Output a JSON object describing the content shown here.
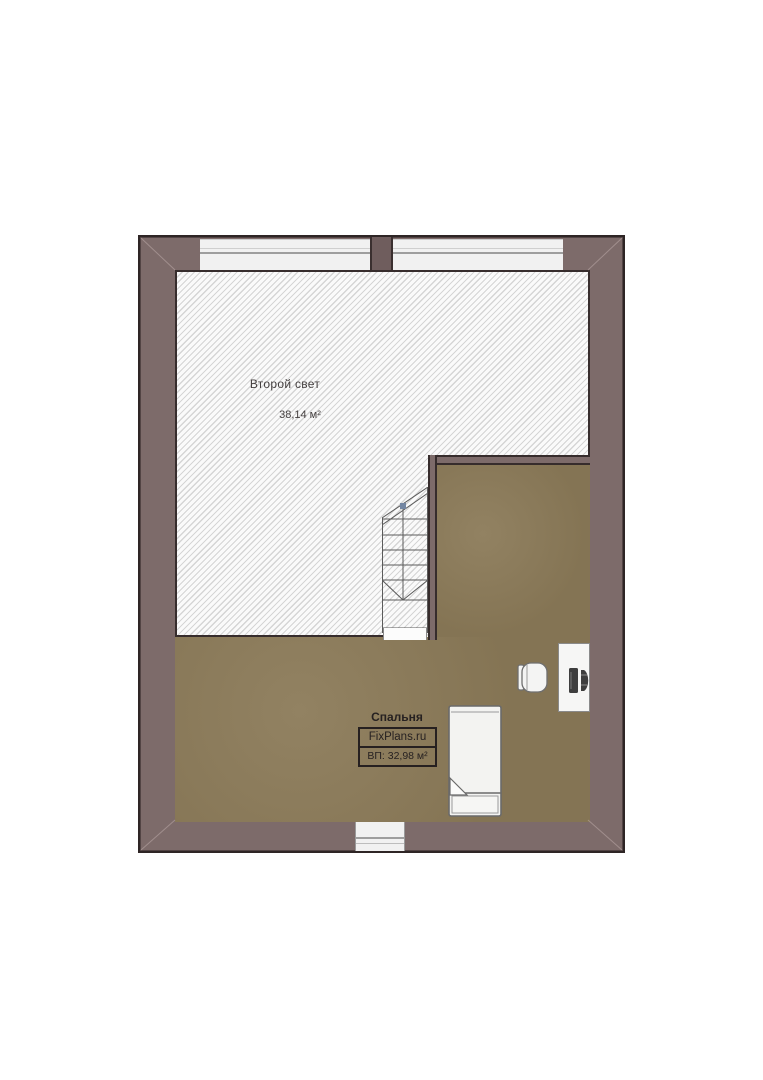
{
  "colors": {
    "wall_fill": "#7d6b6a",
    "wall_dark": "#2e2525",
    "floor_wood": "#8b7a58",
    "hatch_bg": "#fafafa",
    "hatch_line": "#d5d5d5",
    "window_fill": "#f1f1f1",
    "line_gray": "#9e9e9e",
    "stair_marker": "#7386a2",
    "text_dark": "#262121",
    "text_gray": "#454040"
  },
  "rooms": {
    "second_light": {
      "name": "Второй свет",
      "area": "38,14 м²"
    },
    "bedroom": {
      "name": "Спальня",
      "watermark": "FixPlans.ru",
      "ceiling_area": "ВП: 32,98 м²"
    }
  },
  "furniture": {
    "stairs": "staircase-icon",
    "bed": "single-bed-icon",
    "chair": "desk-chair-icon",
    "desk": "computer-desk-icon"
  },
  "windows": {
    "top_left": "window",
    "top_right": "window",
    "bottom": "window"
  }
}
